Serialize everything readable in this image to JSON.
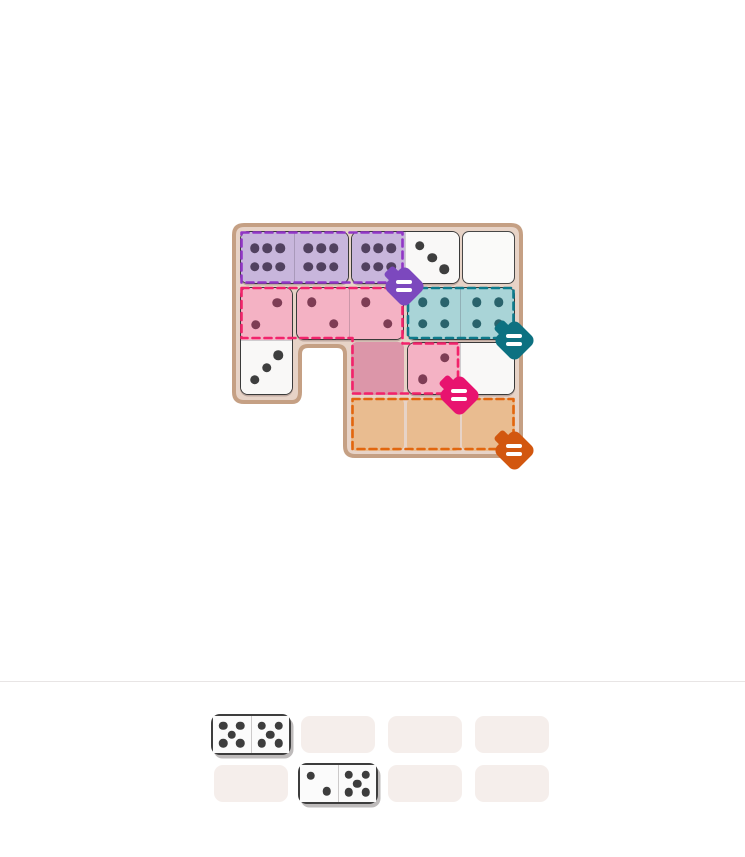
{
  "page": {
    "background": "#ffffff",
    "divider_color": "#e8e5e5"
  },
  "board": {
    "rows": 4,
    "cols": 5,
    "backing": {
      "fill": "#e7d3c7",
      "stroke": "#c5a084"
    },
    "palette": {
      "halves": {
        "purple": "#c8b6dc",
        "pink": "#f4b2c4",
        "teal": "#a9d4d7",
        "white": "#f9f8f7"
      },
      "pips": {
        "purple": "#51415f",
        "pink": "#7e3d55",
        "teal": "#2a636c",
        "white": "#3e3e3e"
      },
      "empty": {
        "outlined": "#fafaf9",
        "pink": "#dc96a9",
        "orange": "#e9bc90"
      },
      "outline": "#3a3a3a"
    },
    "regions": [
      {
        "name": "purple",
        "symbol": "=",
        "dash_color": "#9136c6",
        "badge_color": "#7c48be",
        "cells": [
          [
            0,
            0
          ],
          [
            0,
            1
          ],
          [
            0,
            2
          ]
        ]
      },
      {
        "name": "pink",
        "symbol": "=",
        "dash_color": "#f2236b",
        "badge_color": "#e8136f",
        "cells": [
          [
            1,
            0
          ],
          [
            1,
            1
          ],
          [
            1,
            2
          ],
          [
            2,
            2
          ],
          [
            2,
            3
          ]
        ]
      },
      {
        "name": "teal",
        "symbol": "=",
        "dash_color": "#0e7b8c",
        "badge_color": "#0d7181",
        "cells": [
          [
            1,
            3
          ],
          [
            1,
            4
          ]
        ]
      },
      {
        "name": "orange",
        "symbol": "=",
        "dash_color": "#e2660e",
        "badge_color": "#d2570f",
        "cells": [
          [
            3,
            2
          ],
          [
            3,
            3
          ],
          [
            3,
            4
          ]
        ]
      }
    ],
    "empty_cells": [
      {
        "row": 0,
        "col": 4,
        "style": "outlined"
      },
      {
        "row": 2,
        "col": 2,
        "style": "pink"
      },
      {
        "row": 3,
        "col": 2,
        "style": "orange"
      },
      {
        "row": 3,
        "col": 3,
        "style": "orange"
      },
      {
        "row": 3,
        "col": 4,
        "style": "orange"
      }
    ],
    "dominoes": [
      {
        "cells": [
          [
            0,
            0
          ],
          [
            0,
            1
          ]
        ],
        "values": [
          6,
          6
        ],
        "tints": [
          "purple",
          "purple"
        ],
        "variants": [
          "a",
          "a"
        ]
      },
      {
        "cells": [
          [
            0,
            2
          ],
          [
            0,
            3
          ]
        ],
        "values": [
          6,
          3
        ],
        "tints": [
          "purple",
          "white"
        ],
        "variants": [
          "a",
          "a"
        ]
      },
      {
        "cells": [
          [
            1,
            0
          ],
          [
            2,
            0
          ]
        ],
        "values": [
          2,
          3
        ],
        "tints": [
          "pink",
          "white"
        ],
        "variants": [
          "b",
          "b"
        ]
      },
      {
        "cells": [
          [
            1,
            1
          ],
          [
            1,
            2
          ]
        ],
        "values": [
          2,
          2
        ],
        "tints": [
          "pink",
          "pink"
        ],
        "variants": [
          "a",
          "a"
        ]
      },
      {
        "cells": [
          [
            1,
            3
          ],
          [
            1,
            4
          ]
        ],
        "values": [
          4,
          4
        ],
        "tints": [
          "teal",
          "teal"
        ],
        "variants": [
          "a",
          "a"
        ]
      },
      {
        "cells": [
          [
            2,
            3
          ],
          [
            2,
            4
          ]
        ],
        "values": [
          2,
          0
        ],
        "tints": [
          "pink",
          "white"
        ],
        "variants": [
          "b",
          "a"
        ]
      }
    ]
  },
  "tray": {
    "slot_color": "#f5eeeb",
    "rows": [
      [
        {
          "values": [
            5,
            5
          ],
          "variants": [
            "a",
            "a"
          ]
        },
        null,
        null,
        null
      ],
      [
        null,
        {
          "values": [
            2,
            5
          ],
          "variants": [
            "a",
            "a"
          ]
        },
        null,
        null
      ]
    ]
  }
}
